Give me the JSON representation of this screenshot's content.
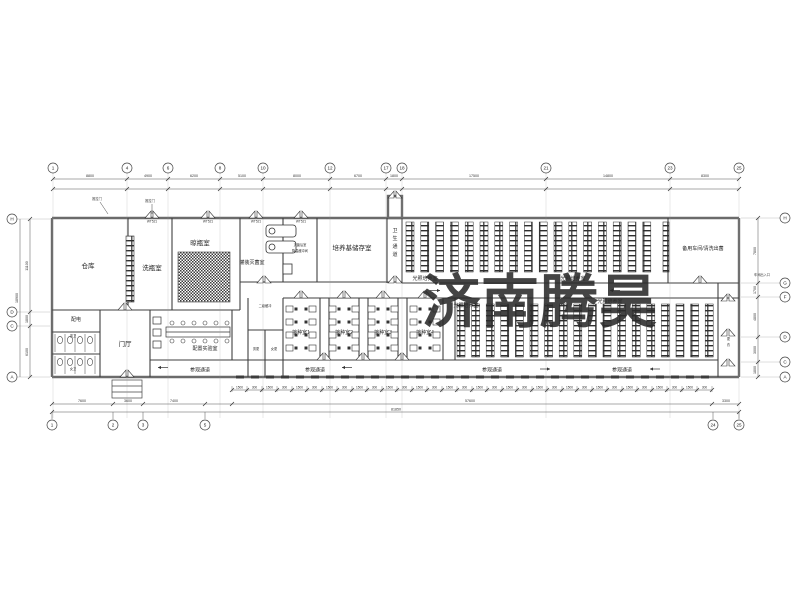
{
  "watermark": {
    "text": "济南腾昊",
    "color": "#E8474E",
    "opacity": 0.88
  },
  "rooms": {
    "warehouse": "仓库",
    "bottle_wash": "洗瓶室",
    "bottle_dry": "晾瓶室",
    "filling_sterilize": "灌装灭菌室",
    "post_sterilize": "灭菌后室",
    "cooling_buffer": "降温缓冲间",
    "medium_storage": "培养基储存室",
    "hygiene_corridor": "卫生通道",
    "light_culture": "光照培养室",
    "spare_workshop": "备用车间/清洗出菌",
    "secondary_buffer": "二级缓冲",
    "inoculation_1": "接种室1",
    "inoculation_2": "接种室2",
    "inoculation_3": "接种室3",
    "inoculation_4": "接种室4",
    "men_changing": "男更",
    "women_changing": "女更",
    "entrance_hall": "门厅",
    "power_room": "配电",
    "men_toilet": "男卫",
    "women_toilet": "女卫",
    "prep_lab": "配置实验室",
    "visitor_corridor": "参观通道",
    "changing_corridor": "更衣",
    "workshop_entrance": "车间出入口",
    "sliding_door": "推拉门",
    "door_tag": "WT521"
  },
  "grid": {
    "top": {
      "y": 168,
      "items": [
        {
          "n": "1",
          "x": 53
        },
        {
          "n": "4",
          "x": 127
        },
        {
          "n": "6",
          "x": 168
        },
        {
          "n": "8",
          "x": 220
        },
        {
          "n": "10",
          "x": 263
        },
        {
          "n": "12",
          "x": 330
        },
        {
          "n": "17",
          "x": 386
        },
        {
          "n": "18",
          "x": 402
        },
        {
          "n": "21",
          "x": 546
        },
        {
          "n": "23",
          "x": 670
        },
        {
          "n": "25",
          "x": 739
        }
      ]
    },
    "bottom": {
      "y": 425,
      "items": [
        {
          "n": "1",
          "x": 52
        },
        {
          "n": "2",
          "x": 113
        },
        {
          "n": "3",
          "x": 143
        },
        {
          "n": "5",
          "x": 205
        },
        {
          "n": "24",
          "x": 713
        },
        {
          "n": "25",
          "x": 739
        }
      ]
    },
    "left": {
      "x": 12,
      "items": [
        {
          "n": "H",
          "y": 219
        },
        {
          "n": "D",
          "y": 312
        },
        {
          "n": "C",
          "y": 326
        },
        {
          "n": "A",
          "y": 377
        }
      ]
    },
    "right": {
      "x": 785,
      "items": [
        {
          "n": "H",
          "y": 218
        },
        {
          "n": "G",
          "y": 283
        },
        {
          "n": "F",
          "y": 297
        },
        {
          "n": "D",
          "y": 337
        },
        {
          "n": "C",
          "y": 362
        },
        {
          "n": "A",
          "y": 377
        }
      ]
    }
  },
  "dims": {
    "top": [
      {
        "t": "8800",
        "x": 90
      },
      {
        "t": "4900",
        "x": 148
      },
      {
        "t": "6200",
        "x": 194
      },
      {
        "t": "5100",
        "x": 242
      },
      {
        "t": "8000",
        "x": 297
      },
      {
        "t": "6700",
        "x": 358
      },
      {
        "t": "1800",
        "x": 394
      },
      {
        "t": "17500",
        "x": 474
      },
      {
        "t": "14800",
        "x": 608
      },
      {
        "t": "8300",
        "x": 705
      }
    ],
    "bottom_segments": [
      {
        "t": "7600",
        "x": 82
      },
      {
        "t": "3600",
        "x": 128
      },
      {
        "t": "7400",
        "x": 174
      },
      {
        "t": "3300",
        "x": 726
      }
    ],
    "bottom_long": {
      "t": "57600",
      "x": 470
    },
    "bottom_total": {
      "t": "81850",
      "x": 396
    },
    "left": [
      {
        "t": "11100",
        "y": 266
      },
      {
        "t": "1800",
        "y": 319
      },
      {
        "t": "6100",
        "y": 352
      }
    ],
    "left_total": {
      "t": "18900",
      "y": 298
    },
    "right": [
      {
        "t": "7800",
        "y": 251
      },
      {
        "t": "1700",
        "y": 290
      },
      {
        "t": "4800",
        "y": 317
      },
      {
        "t": "3000",
        "y": 350
      },
      {
        "t": "1800",
        "y": 370
      }
    ],
    "tick_labels": [
      "1500",
      "300"
    ]
  },
  "plan": {
    "racks": [
      {
        "x0": 406,
        "y0": 222,
        "h": 50,
        "count": 17,
        "pitch": 14.8,
        "w": 8
      },
      {
        "x0": 457,
        "y0": 304,
        "h": 53,
        "count": 18,
        "pitch": 14.6,
        "w": 8
      }
    ],
    "windows": {
      "x0": 236,
      "x1": 706,
      "step": 15,
      "y": 375.5,
      "w": 8
    },
    "ticks": {
      "x0": 232,
      "x1": 712,
      "step": 15,
      "y": 390
    },
    "doors": [
      [
        152,
        218
      ],
      [
        208,
        218
      ],
      [
        256,
        218
      ],
      [
        301,
        218
      ],
      [
        395,
        198
      ],
      [
        395,
        283
      ],
      [
        700,
        283
      ],
      [
        301,
        298
      ],
      [
        344,
        298
      ],
      [
        383,
        298
      ],
      [
        425,
        298
      ],
      [
        324,
        360
      ],
      [
        363,
        360
      ],
      [
        402,
        360
      ],
      [
        728,
        301
      ],
      [
        728,
        336
      ],
      [
        728,
        366
      ],
      [
        127,
        377
      ],
      [
        125,
        310
      ],
      [
        264,
        283
      ]
    ],
    "door_tags": [
      {
        "x": 152,
        "y": 222.5
      },
      {
        "x": 208,
        "y": 222.5
      },
      {
        "x": 256,
        "y": 222.5
      },
      {
        "x": 301,
        "y": 222.5
      }
    ],
    "repeat_labels": [
      {
        "key": "light_culture",
        "x": 425,
        "y": 280,
        "cls": "room-sm"
      },
      {
        "key": "light_culture",
        "x": 573,
        "y": 280,
        "cls": "room-sm"
      },
      {
        "key": "light_culture",
        "x": 466,
        "y": 307,
        "cls": "room-sm"
      },
      {
        "key": "light_culture",
        "x": 610,
        "y": 303,
        "cls": "room-sm"
      },
      {
        "key": "visitor_corridor",
        "x": 200,
        "y": 371.5,
        "cls": "room-sm"
      },
      {
        "key": "visitor_corridor",
        "x": 315,
        "y": 371.5,
        "cls": "room-sm"
      },
      {
        "key": "visitor_corridor",
        "x": 492,
        "y": 371.5,
        "cls": "room-sm"
      },
      {
        "key": "visitor_corridor",
        "x": 622,
        "y": 371.5,
        "cls": "room-sm"
      }
    ],
    "inoculation_centers": [
      301,
      344,
      383,
      425
    ],
    "arrows": [
      [
        168,
        367.5,
        -1
      ],
      [
        352,
        367.5,
        -1
      ],
      [
        540,
        369,
        1
      ],
      [
        660,
        369,
        -1
      ],
      [
        430,
        290.5,
        1
      ],
      [
        620,
        290.5,
        -1
      ]
    ]
  }
}
